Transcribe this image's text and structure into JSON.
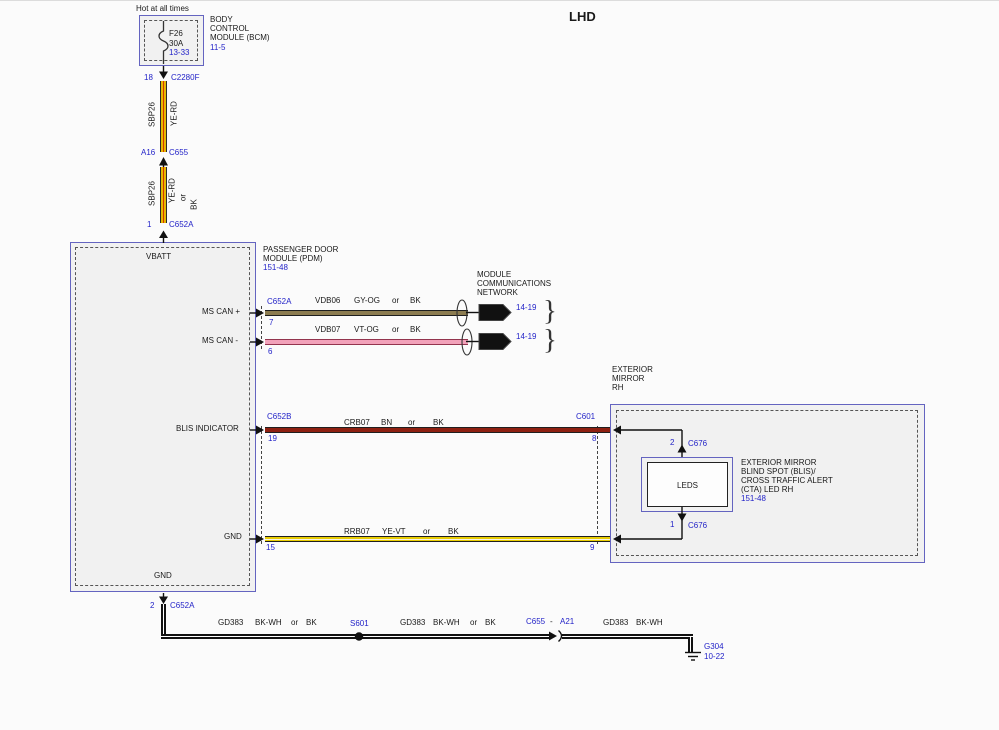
{
  "title": "LHD",
  "power": {
    "hot_label": "Hot at all times",
    "fuse_name": "F26",
    "fuse_rating": "30A",
    "fuse_ref": "13-33",
    "bcm_line1": "BODY",
    "bcm_line2": "CONTROL",
    "bcm_line3": "MODULE (BCM)",
    "bcm_ref": "11-5",
    "pin": "18",
    "connector": "C2280F"
  },
  "feed": {
    "s1_circuit": "SBP26",
    "s1_color": "YE-RD",
    "mid_pin": "A16",
    "mid_conn": "C655",
    "s2_circuit": "SBP26",
    "s2_color": "YE-RD",
    "s2_or": "or",
    "s2_alt": "BK",
    "in_pin": "1",
    "in_conn": "C652A"
  },
  "pdm": {
    "name_line1": "PASSENGER DOOR",
    "name_line2": "MODULE (PDM)",
    "ref": "151-48",
    "vbatt": "VBATT",
    "can_p": "MS CAN +",
    "can_m": "MS CAN -",
    "blis": "BLIS INDICATOR",
    "gnd": "GND",
    "gnd_out": "GND"
  },
  "canp": {
    "conn": "C652A",
    "pin": "7",
    "circuit": "VDB06",
    "color": "GY-OG",
    "or": "or",
    "alt": "BK",
    "ref": "14-19"
  },
  "canm": {
    "pin": "6",
    "circuit": "VDB07",
    "color": "VT-OG",
    "or": "or",
    "alt": "BK",
    "ref": "14-19"
  },
  "network": {
    "line1": "MODULE",
    "line2": "COMMUNICATIONS",
    "line3": "NETWORK",
    "brace": "}"
  },
  "blisw": {
    "conn_l": "C652B",
    "pin_l": "19",
    "circuit": "CRB07",
    "color": "BN",
    "or": "or",
    "alt": "BK",
    "conn_r": "C601",
    "pin_r": "8"
  },
  "gndw": {
    "pin_l": "15",
    "circuit": "RRB07",
    "color": "YE-VT",
    "or": "or",
    "alt": "BK",
    "pin_r": "9"
  },
  "mirror": {
    "name_line1": "EXTERIOR",
    "name_line2": "MIRROR",
    "name_line3": "RH",
    "pin_top": "2",
    "conn_top": "C676",
    "leds": "LEDS",
    "pin_bot": "1",
    "conn_bot": "C676",
    "desc_line1": "EXTERIOR MIRROR",
    "desc_line2": "BLIND SPOT (BLIS)/",
    "desc_line3": "CROSS TRAFFIC ALERT",
    "desc_line4": "(CTA) LED RH",
    "ref": "151-48"
  },
  "gpath": {
    "pin": "2",
    "conn": "C652A",
    "s1_circuit": "GD383",
    "s1_color": "BK-WH",
    "s1_or": "or",
    "s1_alt": "BK",
    "splice": "S601",
    "s2_circuit": "GD383",
    "s2_color": "BK-WH",
    "s2_or": "or",
    "s2_alt": "BK",
    "conn2": "C655",
    "dash": "-",
    "conn2_pin": "A21",
    "s3_circuit": "GD383",
    "s3_color": "BK-WH",
    "ground": "G304",
    "ground_ref": "10-22"
  },
  "symbols": {
    "fuse": "fuse-icon",
    "twisted_pair": "twisted-pair-icon",
    "network_connector": "off-page-connector-icon",
    "splice": "splice-icon",
    "ground": "ground-icon",
    "inline_connector": "inline-connector-icon"
  },
  "colors": {
    "blue_text": "#2323c8",
    "box_border": "#6464c0",
    "box_fill": "#f1f1f1",
    "ye_rd": "#e8b702",
    "rd_stripe": "#d33a00",
    "gy_og": "#8c7c50",
    "vt_og": "#f2a2ba",
    "bn": "#8e2011",
    "ye_vt": "#e9cd04",
    "bk_wh": "#111111"
  }
}
